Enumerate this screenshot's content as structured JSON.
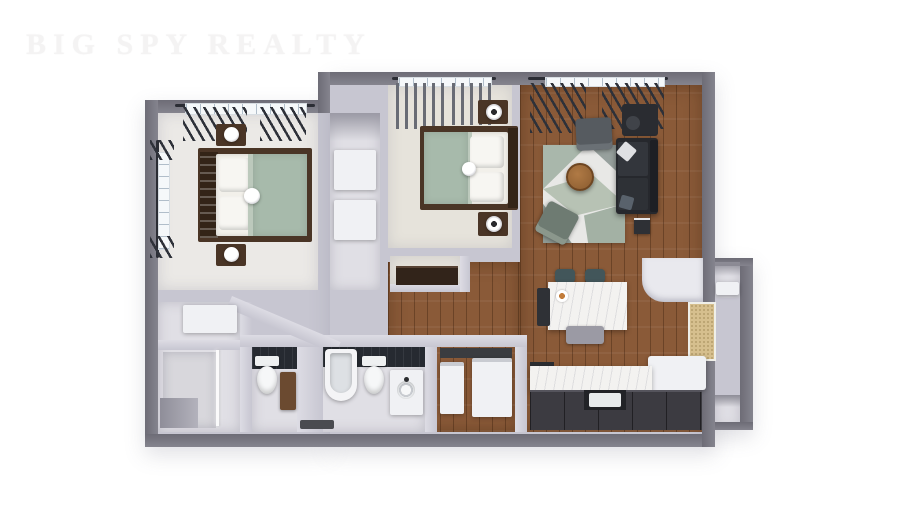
{
  "watermark": {
    "text": "BIG SPY REALTY"
  },
  "palette": {
    "bg": "#ffffff",
    "watermark": "#f4f3f3",
    "wall-outer": "#85848e",
    "wall-outer-dark": "#6d6c76",
    "wall-inner": "#c7c6d1",
    "floor-carpet": "#ebe9e6",
    "floor-beige": "#e6e3db",
    "floor-gray": "#e0dfe5",
    "wood": "#8a5a38",
    "sage": "#a7baab",
    "charcoal": "#26282d",
    "marble": "#f3f2f0",
    "tile-dark": "#262a31",
    "tan": "#d6bf8e",
    "brown-furn": "#4a3526",
    "teal": "#42565a",
    "white-furn": "#f0f1f4"
  },
  "scene": {
    "type": "3d-rendered-floor-plan",
    "view": "top-down-dollhouse",
    "rooms": [
      {
        "name": "bedroom-1",
        "furniture": [
          "double-bed-sage-blanket",
          "nightstand-with-lamp-top",
          "nightstand-with-lamp-bottom",
          "window-left-wall",
          "window-top-wall",
          "dark-curtains"
        ]
      },
      {
        "name": "closet-column",
        "furniture": [
          "wardrobe-shelves"
        ]
      },
      {
        "name": "bedroom-2",
        "furniture": [
          "double-bed-sage-blanket",
          "nightstand-with-round-lamp-top",
          "nightstand-with-round-lamp-bottom",
          "dresser",
          "window-top-wall",
          "gray-curtains"
        ]
      },
      {
        "name": "living-room",
        "furniture": [
          "geometric-rug",
          "charcoal-sofa",
          "gray-armchair",
          "sage-armchair",
          "round-wood-coffee-table",
          "desk-with-chair",
          "side-table",
          "window-top-wall",
          "dark-curtains"
        ]
      },
      {
        "name": "kitchen-dining",
        "furniture": [
          "marble-island-table",
          "two-teal-stools",
          "dining-chair",
          "trash-bin",
          "fruit-plate",
          "marble-countertop",
          "dark-lower-cabinets",
          "sink",
          "stove",
          "white-bench",
          "coat-closet",
          "tan-entry-door-mat"
        ]
      },
      {
        "name": "bathroom-1",
        "furniture": [
          "toilet",
          "dark-tile-wall",
          "wood-vanity-cabinet"
        ]
      },
      {
        "name": "bathroom-2",
        "furniture": [
          "bathtub",
          "toilet",
          "dark-tile-wall",
          "vanity-with-round-sink",
          "floor-mat"
        ]
      },
      {
        "name": "laundry-closet",
        "furniture": [
          "washer",
          "dryer",
          "dark-shelf"
        ]
      },
      {
        "name": "shower-room",
        "furniture": [
          "walk-in-glass-shower",
          "shelf-box",
          "storage-nook"
        ]
      },
      {
        "name": "hallway",
        "furniture": [
          "angled-wall"
        ]
      },
      {
        "name": "entry-nooks",
        "furniture": [
          "upper-right-nook-shelf",
          "lower-right-nook"
        ]
      }
    ]
  }
}
